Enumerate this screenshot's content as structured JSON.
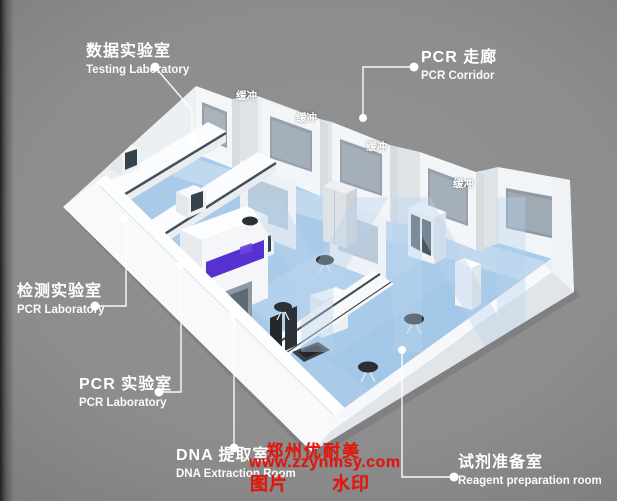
{
  "scene": {
    "description": "3D isometric rendering of a PCR laboratory suite on gray background",
    "background_color": "#8d8d8d",
    "floor_color": "#a9cbe9",
    "wall_color": "#f3f6f8",
    "window_color": "#96a1ab",
    "accent_purple": "#5631d0",
    "stool_color": "#2c3034"
  },
  "callouts": {
    "testing_lab": {
      "zh": "数据实验室",
      "en": "Testing Laboratory"
    },
    "pcr_corridor": {
      "zh": "PCR 走廊",
      "en": "PCR Corridor"
    },
    "inspection_lab": {
      "zh": "检测实验室",
      "en": "PCR Laboratory"
    },
    "pcr_lab": {
      "zh": "PCR 实验室",
      "en": "PCR Laboratory"
    },
    "dna_room": {
      "zh": "DNA 提取室",
      "en": "DNA Extraction Room"
    },
    "reagent_room": {
      "zh": "试剂准备室",
      "en": "Reagent preparation room"
    }
  },
  "model": {
    "buffer_label": "缓冲",
    "watermark_letters": "YN"
  },
  "red_watermark": {
    "company": "郑州优耐美",
    "url": "www.zzynmsy.com",
    "left_text": "图片",
    "right_text": "水印",
    "color": "#ea1309"
  }
}
